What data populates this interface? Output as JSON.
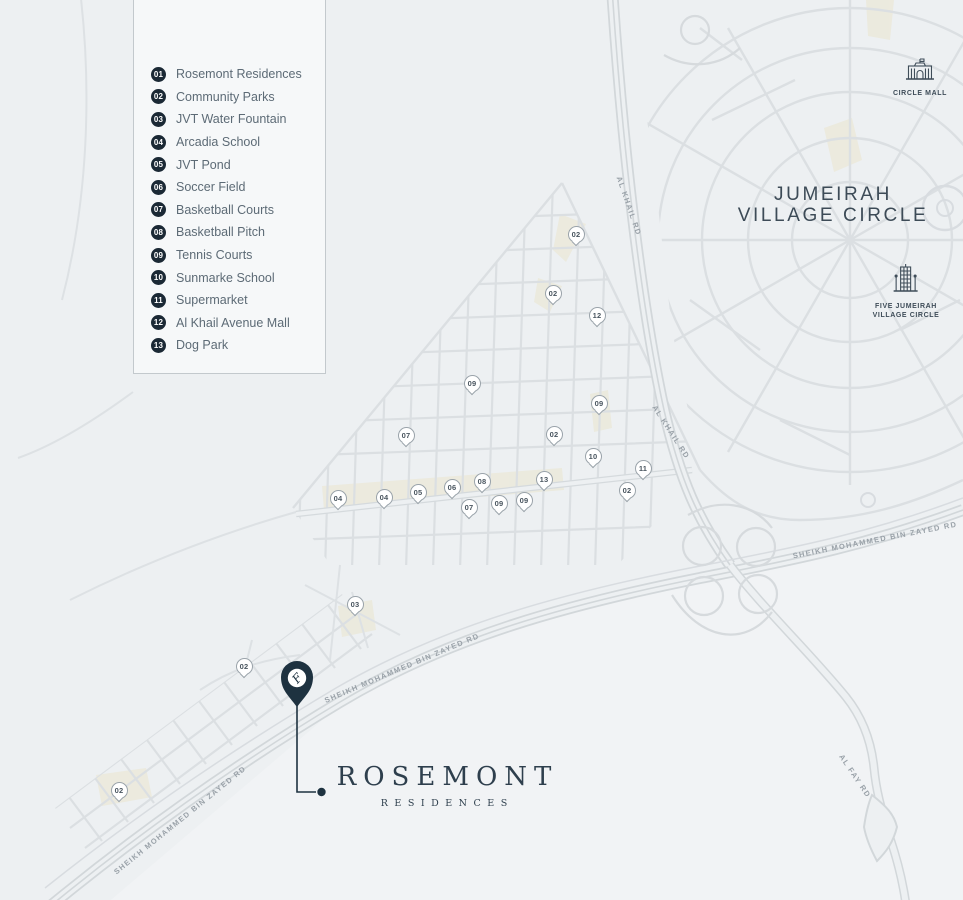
{
  "legend": {
    "items": [
      {
        "num": "01",
        "label": "Rosemont Residences"
      },
      {
        "num": "02",
        "label": "Community Parks"
      },
      {
        "num": "03",
        "label": "JVT Water Fountain"
      },
      {
        "num": "04",
        "label": "Arcadia School"
      },
      {
        "num": "05",
        "label": "JVT Pond"
      },
      {
        "num": "06",
        "label": "Soccer Field"
      },
      {
        "num": "07",
        "label": "Basketball Courts"
      },
      {
        "num": "08",
        "label": "Basketball Pitch"
      },
      {
        "num": "09",
        "label": "Tennis Courts"
      },
      {
        "num": "10",
        "label": "Sunmarke School"
      },
      {
        "num": "11",
        "label": "Supermarket"
      },
      {
        "num": "12",
        "label": "Al Khail Avenue Mall"
      },
      {
        "num": "13",
        "label": "Dog Park"
      }
    ]
  },
  "map": {
    "area_label": {
      "line1": "JUMEIRAH",
      "line2": "VILLAGE CIRCLE"
    },
    "landmarks": {
      "circle_mall": {
        "label": "CIRCLE MALL"
      },
      "five_jvc": {
        "line1": "FIVE JUMEIRAH",
        "line2": "VILLAGE CIRCLE"
      }
    },
    "road_labels": [
      {
        "text": "AL KHAIL RD",
        "x": 629,
        "y": 206,
        "angle": 71
      },
      {
        "text": "AL KHAIL RD",
        "x": 671,
        "y": 432,
        "angle": 57
      },
      {
        "text": "SHEIKH MOHAMMED BIN ZAYED RD",
        "x": 875,
        "y": 540,
        "angle": -11
      },
      {
        "text": "SHEIKH MOHAMMED BIN ZAYED RD",
        "x": 402,
        "y": 668,
        "angle": -23
      },
      {
        "text": "SHEIKH MOHAMMED BIN ZAYED RD",
        "x": 180,
        "y": 820,
        "angle": -39
      },
      {
        "text": "AL FAY RD",
        "x": 855,
        "y": 776,
        "angle": 56
      }
    ],
    "markers": [
      {
        "n": "02",
        "x": 576,
        "y": 234
      },
      {
        "n": "02",
        "x": 553,
        "y": 293
      },
      {
        "n": "12",
        "x": 597,
        "y": 315
      },
      {
        "n": "09",
        "x": 472,
        "y": 383
      },
      {
        "n": "09",
        "x": 599,
        "y": 403
      },
      {
        "n": "07",
        "x": 406,
        "y": 435
      },
      {
        "n": "02",
        "x": 554,
        "y": 434
      },
      {
        "n": "10",
        "x": 593,
        "y": 456
      },
      {
        "n": "11",
        "x": 643,
        "y": 468
      },
      {
        "n": "02",
        "x": 627,
        "y": 490
      },
      {
        "n": "04",
        "x": 338,
        "y": 498
      },
      {
        "n": "04",
        "x": 384,
        "y": 497
      },
      {
        "n": "05",
        "x": 418,
        "y": 492
      },
      {
        "n": "06",
        "x": 452,
        "y": 487
      },
      {
        "n": "08",
        "x": 482,
        "y": 481
      },
      {
        "n": "13",
        "x": 544,
        "y": 479
      },
      {
        "n": "07",
        "x": 469,
        "y": 507
      },
      {
        "n": "09",
        "x": 499,
        "y": 503
      },
      {
        "n": "09",
        "x": 524,
        "y": 500
      },
      {
        "n": "03",
        "x": 355,
        "y": 604
      },
      {
        "n": "02",
        "x": 244,
        "y": 666
      },
      {
        "n": "02",
        "x": 119,
        "y": 790
      }
    ],
    "pin_monogram": "F"
  },
  "logo": {
    "name": "ROSEMONT",
    "subtitle": "RESIDENCES"
  },
  "colors": {
    "pin": "#1e3240",
    "badge": "#1b2935",
    "accent": "#3d4b57",
    "road": "#dbdfe2",
    "cream": "#ebe9db"
  }
}
